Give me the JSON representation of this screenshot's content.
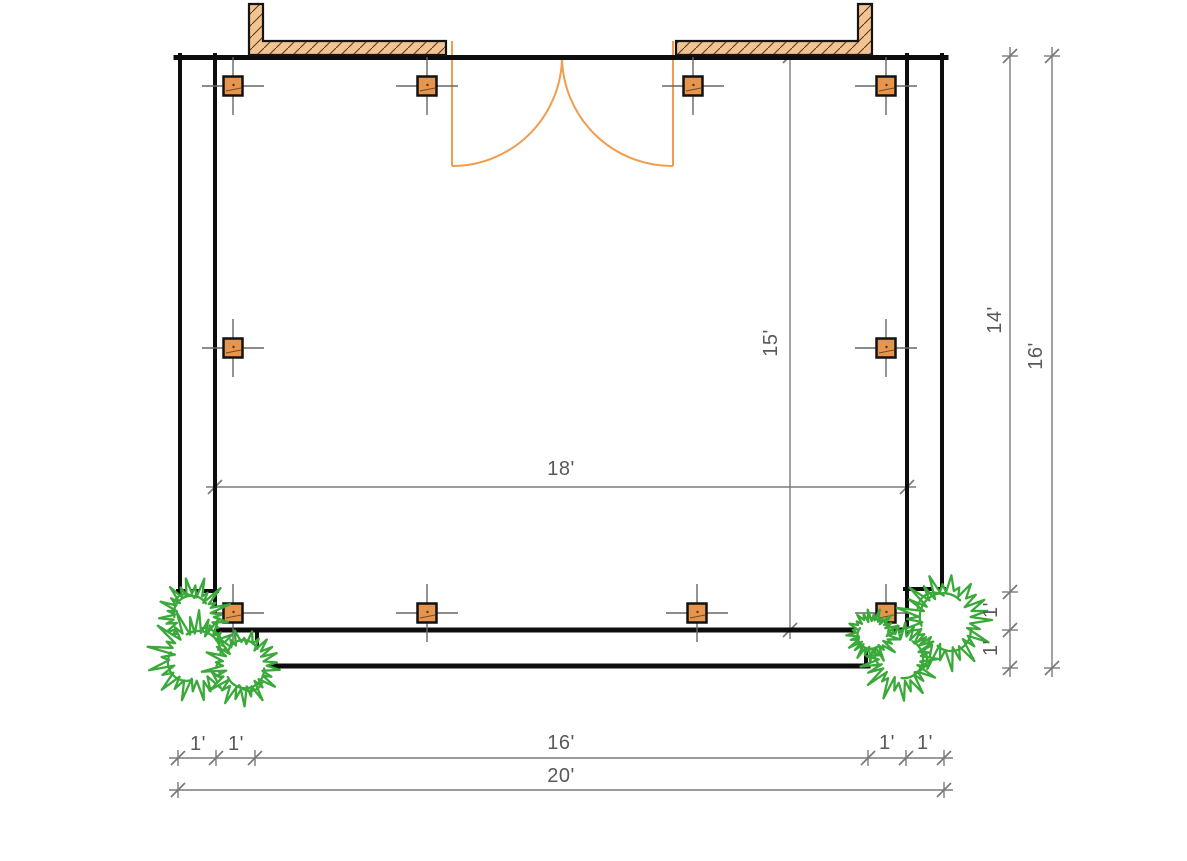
{
  "canvas": {
    "width": 1187,
    "height": 861,
    "background": "#ffffff"
  },
  "colors": {
    "wall": "#0d0d0d",
    "post_fill": "#e6954e",
    "post_border": "#121212",
    "post_grain": "#7a4a1d",
    "beam_fill": "#f2c493",
    "beam_hatch": "#5d3b15",
    "beam_outline": "#141414",
    "door": "#f09d4f",
    "dimension_line": "#7a7a7a",
    "dimension_text": "#595959",
    "plant": "#3aa93a"
  },
  "labels": {
    "interior_width": "18'",
    "interior_depth": "15'",
    "side_depth": "14'",
    "side_step_a": "1'",
    "side_step_b": "1'",
    "side_total": "16'",
    "front_overhang_a": "1'",
    "front_overhang_b": "1'",
    "front_span": "16'",
    "front_overhang_c": "1'",
    "front_overhang_d": "1'",
    "front_total": "20'"
  },
  "plan": {
    "structure_kind": "deck-floor-plan",
    "wall_segments": [
      {
        "x1": 176,
        "y1": 57.5,
        "x2": 946,
        "y2": 57.5,
        "w": 5
      },
      {
        "x1": 180,
        "y1": 55,
        "x2": 180,
        "y2": 593,
        "w": 4
      },
      {
        "x1": 215,
        "y1": 55,
        "x2": 215,
        "y2": 632,
        "w": 4
      },
      {
        "x1": 178,
        "y1": 591,
        "x2": 217,
        "y2": 591,
        "w": 4
      },
      {
        "x1": 942,
        "y1": 55,
        "x2": 942,
        "y2": 591,
        "w": 4
      },
      {
        "x1": 907,
        "y1": 55,
        "x2": 907,
        "y2": 632,
        "w": 4
      },
      {
        "x1": 905,
        "y1": 589,
        "x2": 944,
        "y2": 589,
        "w": 4
      },
      {
        "x1": 213,
        "y1": 630,
        "x2": 909,
        "y2": 630,
        "w": 5
      },
      {
        "x1": 257,
        "y1": 630,
        "x2": 257,
        "y2": 666,
        "w": 4
      },
      {
        "x1": 255,
        "y1": 666,
        "x2": 868,
        "y2": 666,
        "w": 5
      },
      {
        "x1": 866,
        "y1": 630,
        "x2": 866,
        "y2": 666,
        "w": 4
      }
    ],
    "beams": [
      {
        "d": "M249,4 L263,4 L263,41 L446,41 L446,55 L249,55 Z"
      },
      {
        "d": "M676,41 L858,41 L858,4 L872,4 L872,55 L676,55 Z"
      }
    ],
    "door": {
      "kind": "double-swing-door",
      "leaves": [
        [
          452,
          41,
          452,
          166
        ],
        [
          673,
          41,
          673,
          166
        ]
      ],
      "arcs": [
        "M452,166 A110,110 0 0 0 562,56",
        "M673,166 A110,110 0 0 1 562,56"
      ]
    },
    "posts": {
      "count": 10,
      "size": 19,
      "centers": [
        [
          233,
          86
        ],
        [
          427,
          86
        ],
        [
          693,
          86
        ],
        [
          886,
          86
        ],
        [
          233,
          348
        ],
        [
          886,
          348
        ],
        [
          233,
          613
        ],
        [
          427,
          613
        ],
        [
          697,
          613
        ],
        [
          886,
          613
        ]
      ]
    },
    "plants": [
      {
        "cx": 193,
        "cy": 616,
        "r": 35,
        "rot": 10
      },
      {
        "cx": 196,
        "cy": 656,
        "r": 44,
        "rot": 80
      },
      {
        "cx": 244,
        "cy": 666,
        "r": 38,
        "rot": 200
      },
      {
        "cx": 946,
        "cy": 620,
        "r": 47,
        "rot": 0
      },
      {
        "cx": 900,
        "cy": 658,
        "r": 39,
        "rot": 140
      },
      {
        "cx": 872,
        "cy": 634,
        "r": 26,
        "rot": 260
      }
    ],
    "dims": [
      {
        "o": "h",
        "pos": 487,
        "from": 215,
        "to": 907
      },
      {
        "o": "v",
        "pos": 790,
        "from": 56,
        "to": 630
      },
      {
        "o": "v",
        "pos": 1010,
        "from": 56,
        "to": 668,
        "ticks": [
          56,
          592,
          630,
          668
        ]
      },
      {
        "o": "v",
        "pos": 1052,
        "from": 56,
        "to": 668
      },
      {
        "o": "h",
        "pos": 758,
        "from": 178,
        "to": 944,
        "ticks": [
          178,
          216,
          255,
          868,
          906,
          944
        ]
      },
      {
        "o": "h",
        "pos": 790,
        "from": 178,
        "to": 944
      }
    ]
  }
}
